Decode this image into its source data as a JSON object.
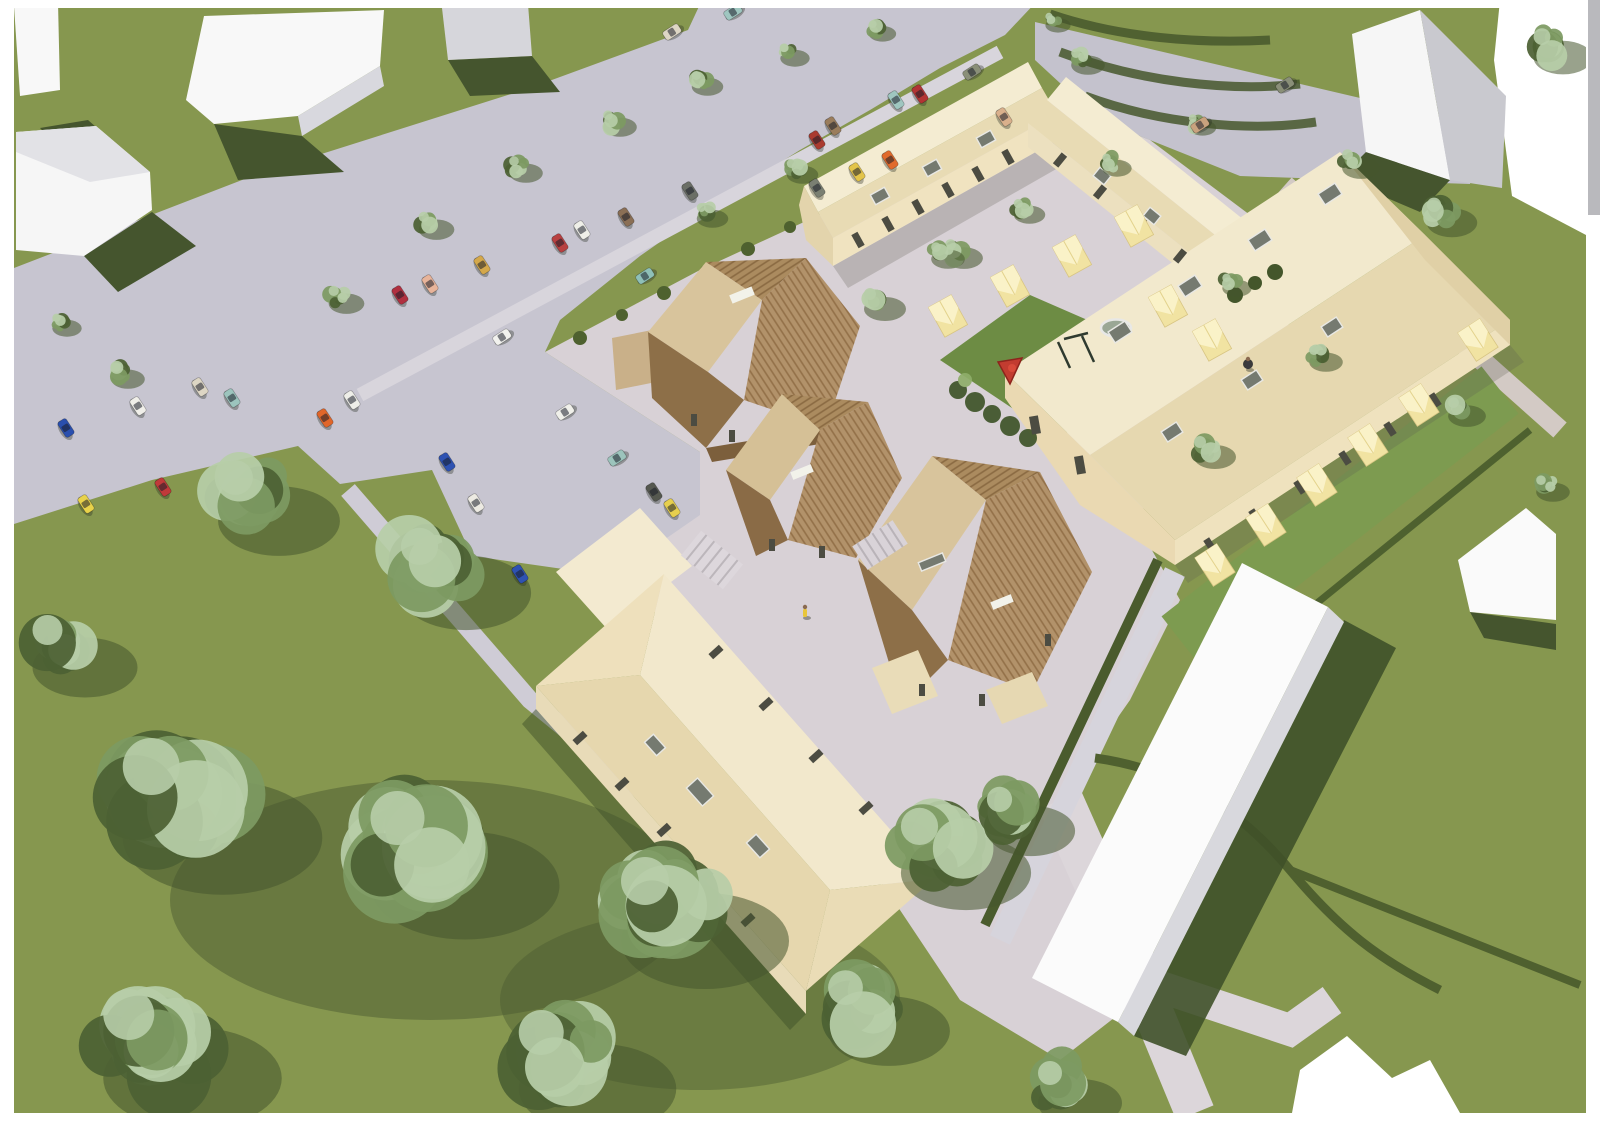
{
  "meta": {
    "content_type": "aerial architectural rendering of a housing development (scanned page)",
    "visible_text": "",
    "page_background": "#ffffff"
  },
  "palette": {
    "grass": "#86974f",
    "grass_shadow": "#45552e",
    "hedge": "#46572c",
    "road": "#c7c5d0",
    "plaza": "#d8d1d6",
    "walk": "#d6d3da",
    "cream_wall": "#f0e3c0",
    "cream_roof_light": "#f4ecd2",
    "cream_roof_dark": "#e8dbb4",
    "shed_yellow": "#f1e3a2",
    "shed_yellow_light": "#faf2c8",
    "timber_light": "#d8c49c",
    "timber_mid": "#aa8a5e",
    "timber_dark": "#8d6f48",
    "white_building": "#fafafa",
    "white_building_side": "#d2d2d8",
    "window_dark": "#4c4c42",
    "skylight_gray": "#757a70",
    "tree_light": "#b7cda8",
    "tree_mid": "#7d9a62",
    "tree_dark": "#4c6134"
  },
  "objects": {
    "cars": [
      {
        "x": 66,
        "y": 428,
        "rot": 57,
        "color": "#2a4fae"
      },
      {
        "x": 138,
        "y": 406,
        "rot": 57,
        "color": "#f0efe9"
      },
      {
        "x": 200,
        "y": 387,
        "rot": 57,
        "color": "#ddd6c4"
      },
      {
        "x": 232,
        "y": 398,
        "rot": 57,
        "color": "#9cc4bd"
      },
      {
        "x": 163,
        "y": 487,
        "rot": 57,
        "color": "#c03a3a"
      },
      {
        "x": 86,
        "y": 504,
        "rot": 57,
        "color": "#e8d24a"
      },
      {
        "x": 325,
        "y": 418,
        "rot": 57,
        "color": "#e0662a"
      },
      {
        "x": 352,
        "y": 400,
        "rot": 57,
        "color": "#eeeee8"
      },
      {
        "x": 447,
        "y": 462,
        "rot": 57,
        "color": "#2e52b2"
      },
      {
        "x": 476,
        "y": 503,
        "rot": 57,
        "color": "#eceae2"
      },
      {
        "x": 520,
        "y": 574,
        "rot": 57,
        "color": "#2e52b2"
      },
      {
        "x": 565,
        "y": 412,
        "rot": -33,
        "color": "#f0f0ea"
      },
      {
        "x": 617,
        "y": 458,
        "rot": -33,
        "color": "#9cc4bc"
      },
      {
        "x": 654,
        "y": 492,
        "rot": 57,
        "color": "#55584f"
      },
      {
        "x": 672,
        "y": 508,
        "rot": 57,
        "color": "#e6cf4e"
      },
      {
        "x": 400,
        "y": 295,
        "rot": 57,
        "color": "#b03040"
      },
      {
        "x": 430,
        "y": 284,
        "rot": 57,
        "color": "#e8b49a"
      },
      {
        "x": 482,
        "y": 265,
        "rot": 57,
        "color": "#d4a84b"
      },
      {
        "x": 502,
        "y": 337,
        "rot": -33,
        "color": "#f2f2ee"
      },
      {
        "x": 560,
        "y": 243,
        "rot": 57,
        "color": "#b84040"
      },
      {
        "x": 582,
        "y": 230,
        "rot": 57,
        "color": "#efefe8"
      },
      {
        "x": 626,
        "y": 217,
        "rot": 57,
        "color": "#8a6f55"
      },
      {
        "x": 645,
        "y": 276,
        "rot": -33,
        "color": "#8fc0b8"
      },
      {
        "x": 690,
        "y": 191,
        "rot": 57,
        "color": "#6b6f66"
      },
      {
        "x": 672,
        "y": 32,
        "rot": -33,
        "color": "#ddd6c4"
      },
      {
        "x": 733,
        "y": 12,
        "rot": -33,
        "color": "#9fc6c0"
      },
      {
        "x": 817,
        "y": 140,
        "rot": 57,
        "color": "#aa3b30"
      },
      {
        "x": 833,
        "y": 126,
        "rot": 57,
        "color": "#9a7d5c"
      },
      {
        "x": 857,
        "y": 172,
        "rot": 57,
        "color": "#e3c44a"
      },
      {
        "x": 817,
        "y": 188,
        "rot": 57,
        "color": "#7a7f72"
      },
      {
        "x": 890,
        "y": 160,
        "rot": 57,
        "color": "#e06a2c"
      },
      {
        "x": 896,
        "y": 100,
        "rot": 57,
        "color": "#9fc6c0"
      },
      {
        "x": 920,
        "y": 94,
        "rot": 57,
        "color": "#b23434"
      },
      {
        "x": 972,
        "y": 72,
        "rot": -33,
        "color": "#8a8f78"
      },
      {
        "x": 1004,
        "y": 117,
        "rot": 57,
        "color": "#d9b08c"
      },
      {
        "x": 1200,
        "y": 125,
        "rot": -33,
        "color": "#c9a27e"
      },
      {
        "x": 1285,
        "y": 85,
        "rot": -33,
        "color": "#8a8f78"
      }
    ],
    "street_trees": [
      [
        338,
        296,
        17
      ],
      [
        428,
        222,
        17
      ],
      [
        518,
        166,
        16
      ],
      [
        612,
        120,
        16
      ],
      [
        700,
        80,
        15
      ],
      [
        788,
        52,
        14
      ],
      [
        876,
        28,
        13
      ],
      [
        705,
        212,
        15
      ],
      [
        795,
        168,
        15
      ],
      [
        940,
        252,
        16
      ],
      [
        1022,
        208,
        15
      ],
      [
        1110,
        162,
        14
      ],
      [
        1196,
        122,
        13
      ],
      [
        1052,
        20,
        12
      ],
      [
        120,
        372,
        16
      ],
      [
        60,
        322,
        14
      ]
    ],
    "lawn_trees": [
      [
        250,
        495,
        58
      ],
      [
        435,
        565,
        62
      ],
      [
        175,
        795,
        95
      ],
      [
        420,
        845,
        90
      ],
      [
        665,
        905,
        80
      ],
      [
        935,
        845,
        62
      ],
      [
        150,
        1040,
        85
      ],
      [
        560,
        1055,
        75
      ],
      [
        860,
        1005,
        58
      ],
      [
        60,
        645,
        50
      ],
      [
        1010,
        812,
        42
      ],
      [
        1060,
        1085,
        40
      ],
      [
        1549,
        45,
        28
      ]
    ],
    "site_trees": [
      [
        875,
        300,
        20
      ],
      [
        955,
        250,
        18
      ],
      [
        1205,
        448,
        20
      ],
      [
        1318,
        355,
        16
      ],
      [
        1440,
        212,
        24
      ],
      [
        1352,
        160,
        18
      ],
      [
        1080,
        58,
        16
      ],
      [
        1458,
        408,
        18
      ],
      [
        1230,
        282,
        14
      ],
      [
        1545,
        485,
        16
      ]
    ],
    "sheds": [
      [
        948,
        316,
        -29
      ],
      [
        1010,
        286,
        -29
      ],
      [
        1072,
        256,
        -29
      ],
      [
        1134,
        226,
        -29
      ],
      [
        1168,
        306,
        -29
      ],
      [
        1212,
        340,
        -29
      ],
      [
        1215,
        565,
        -33
      ],
      [
        1266,
        525,
        -33
      ],
      [
        1317,
        485,
        -33
      ],
      [
        1368,
        445,
        -33
      ],
      [
        1419,
        405,
        -33
      ],
      [
        1478,
        340,
        -33
      ]
    ],
    "glazing": [
      [
        880,
        196,
        16,
        11,
        -29,
        "sky"
      ],
      [
        932,
        168,
        16,
        11,
        -29,
        "sky"
      ],
      [
        986,
        139,
        16,
        11,
        -29,
        "sky"
      ],
      [
        1102,
        176,
        14,
        11,
        39,
        "sky"
      ],
      [
        1152,
        216,
        14,
        11,
        39,
        "sky"
      ],
      [
        1120,
        332,
        20,
        13,
        -33,
        "sky"
      ],
      [
        1190,
        286,
        20,
        13,
        -33,
        "sky"
      ],
      [
        1260,
        240,
        20,
        13,
        -33,
        "sky"
      ],
      [
        1330,
        194,
        20,
        13,
        -33,
        "sky"
      ],
      [
        1172,
        432,
        18,
        12,
        -33,
        "sky"
      ],
      [
        1252,
        380,
        18,
        12,
        -33,
        "sky"
      ],
      [
        1332,
        327,
        18,
        12,
        -33,
        "sky"
      ],
      [
        700,
        792,
        24,
        15,
        48,
        "sky"
      ],
      [
        758,
        846,
        20,
        13,
        48,
        "sky"
      ],
      [
        655,
        745,
        18,
        12,
        48,
        "sky"
      ],
      [
        742,
        295,
        24,
        9,
        -22,
        "skyw"
      ],
      [
        802,
        472,
        22,
        8,
        -22,
        "skyw"
      ],
      [
        932,
        562,
        26,
        9,
        -22,
        "sky"
      ],
      [
        1002,
        602,
        22,
        8,
        -22,
        "skyw"
      ],
      [
        858,
        240,
        7,
        15,
        -29,
        "win"
      ],
      [
        888,
        224,
        7,
        15,
        -29,
        "win"
      ],
      [
        918,
        207,
        7,
        15,
        -29,
        "win"
      ],
      [
        948,
        190,
        7,
        15,
        -29,
        "win"
      ],
      [
        978,
        174,
        7,
        15,
        -29,
        "win"
      ],
      [
        1008,
        157,
        7,
        15,
        -29,
        "win"
      ],
      [
        1060,
        160,
        7,
        14,
        39,
        "win"
      ],
      [
        1100,
        192,
        7,
        14,
        39,
        "win"
      ],
      [
        1140,
        224,
        7,
        14,
        39,
        "win"
      ],
      [
        1180,
        256,
        7,
        14,
        39,
        "win"
      ],
      [
        1210,
        545,
        7,
        14,
        -33,
        "win"
      ],
      [
        1255,
        516,
        7,
        14,
        -33,
        "win"
      ],
      [
        1300,
        487,
        7,
        14,
        -33,
        "win"
      ],
      [
        1345,
        458,
        7,
        14,
        -33,
        "win"
      ],
      [
        1390,
        429,
        7,
        14,
        -33,
        "win"
      ],
      [
        1435,
        400,
        7,
        14,
        -33,
        "win"
      ],
      [
        1035,
        425,
        9,
        18,
        -10,
        "win"
      ],
      [
        1080,
        465,
        9,
        18,
        -10,
        "win"
      ],
      [
        580,
        738,
        7,
        14,
        48,
        "win"
      ],
      [
        622,
        784,
        7,
        14,
        48,
        "win"
      ],
      [
        664,
        830,
        7,
        14,
        48,
        "win"
      ],
      [
        706,
        876,
        7,
        14,
        48,
        "win"
      ],
      [
        748,
        920,
        7,
        14,
        48,
        "win"
      ],
      [
        716,
        652,
        7,
        14,
        48,
        "win"
      ],
      [
        766,
        704,
        7,
        14,
        48,
        "win"
      ],
      [
        816,
        756,
        7,
        14,
        48,
        "win"
      ],
      [
        866,
        808,
        7,
        14,
        48,
        "win"
      ],
      [
        694,
        420,
        6,
        12,
        0,
        "win"
      ],
      [
        732,
        436,
        6,
        12,
        0,
        "win"
      ],
      [
        772,
        545,
        6,
        12,
        0,
        "win"
      ],
      [
        822,
        552,
        6,
        12,
        0,
        "win"
      ],
      [
        922,
        690,
        6,
        12,
        0,
        "win"
      ],
      [
        982,
        700,
        6,
        12,
        0,
        "win"
      ],
      [
        1048,
        640,
        6,
        12,
        0,
        "win"
      ]
    ],
    "people": [
      {
        "x": 805,
        "y": 612,
        "color": "#e8c63a"
      },
      {
        "x": 1248,
        "y": 364,
        "color": "#3a3a3f"
      }
    ],
    "playground": {
      "trampoline": {
        "x": 1116,
        "y": 328,
        "rx": 15,
        "ry": 8.5
      },
      "climber_color": "#c23c30",
      "swing_color": "#2f3a2f"
    }
  }
}
